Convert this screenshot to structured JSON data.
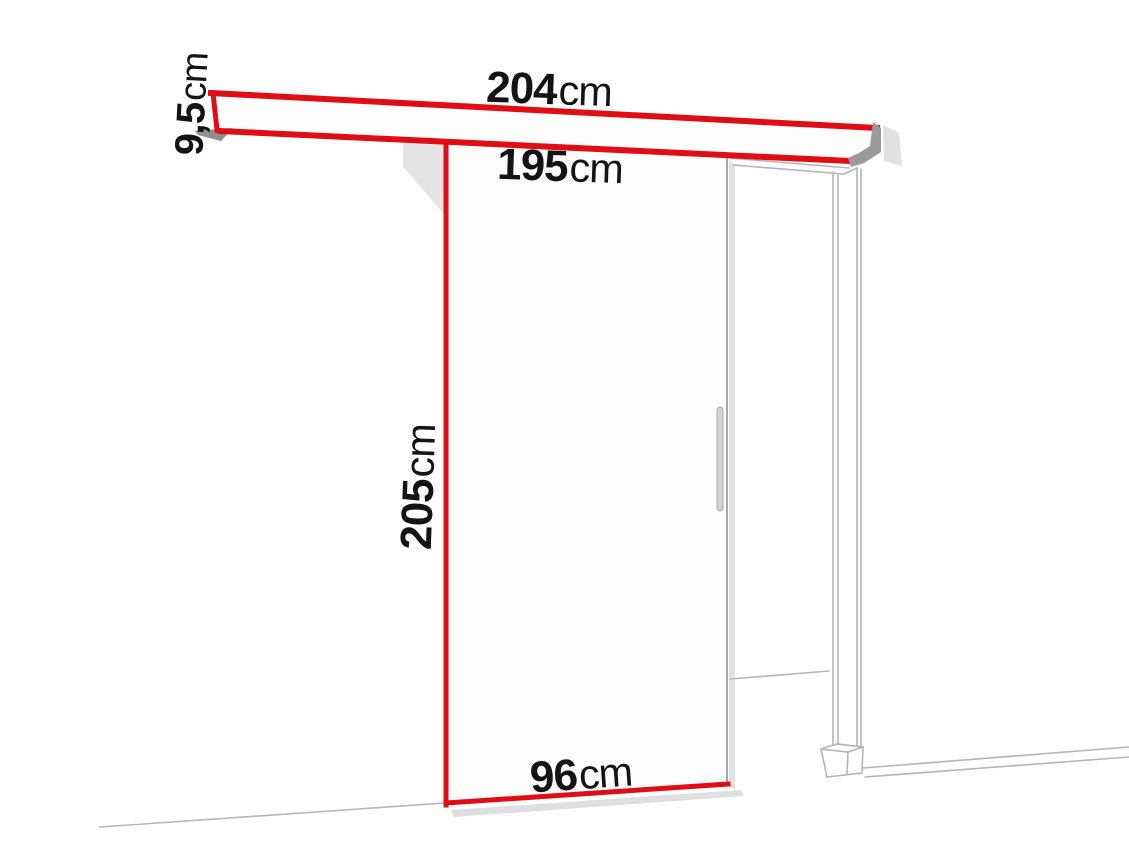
{
  "diagram": {
    "labels": {
      "rail_length": {
        "value": "204",
        "unit": "cm"
      },
      "rail_height": {
        "value": "9,5",
        "unit": "cm"
      },
      "passage_width": {
        "value": "195",
        "unit": "cm"
      },
      "door_height": {
        "value": "205",
        "unit": "cm"
      },
      "door_width": {
        "value": "96",
        "unit": "cm"
      }
    },
    "colors": {
      "accent_red": "#e10d15",
      "frame_gray": "#b5b5b5",
      "shadow_gray": "#9a9a9a",
      "text_black": "#141414",
      "background": "#ffffff"
    }
  }
}
